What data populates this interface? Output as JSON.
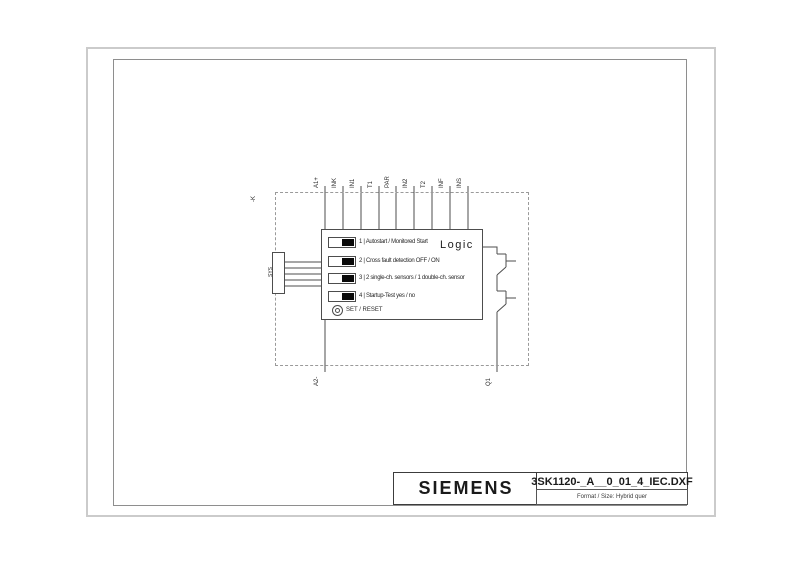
{
  "sheet": {
    "title_block": {
      "brand": "SIEMENS",
      "filename": "3SK1120-_A__0_01_4_IEC.DXF",
      "format_line": "Format / Size: Hybrid quer"
    }
  },
  "diagram": {
    "device_tag": "-K",
    "logic_label": "Logic",
    "connector_label": "SYS",
    "terminals_top": [
      "A1+",
      "INK",
      "IN1",
      "T1",
      "PAR",
      "IN2",
      "T2",
      "INF",
      "INS"
    ],
    "terminals_bottom": [
      "A2-",
      "Q1"
    ],
    "dip_switches": [
      "1 | Autostart / Monitored Start",
      "2 | Cross fault detection OFF / ON",
      "3 | 2 single-ch. sensors / 1 double-ch. sensor",
      "4 | Startup-Test yes / no"
    ],
    "reset_label": "SET / RESET",
    "colors": {
      "line": "#4d4d4d",
      "dashed_boundary": "#9a9a9a",
      "switch_knob": "#0a0a0a"
    }
  }
}
